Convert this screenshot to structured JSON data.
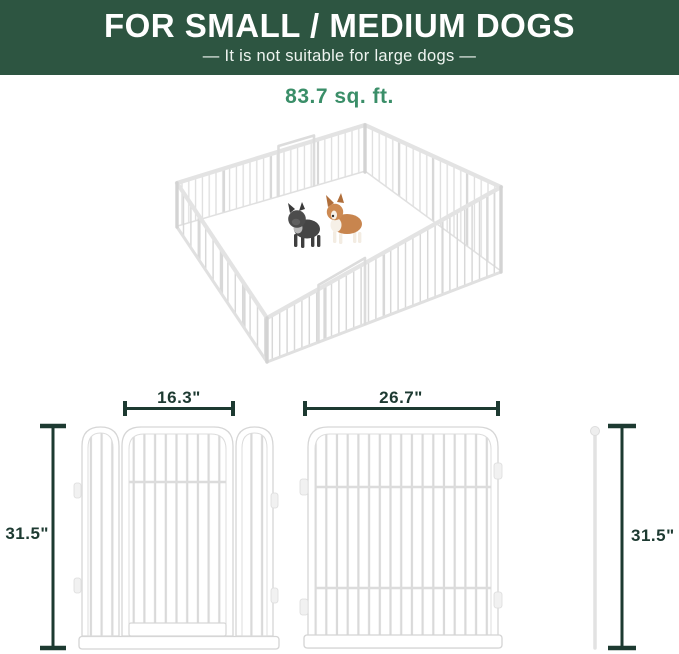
{
  "banner": {
    "title": "FOR SMALL / MEDIUM DOGS",
    "subtitle": "— It is not suitable for large dogs —",
    "bg_color": "#2d5541",
    "text_color": "#ffffff"
  },
  "area_label": "83.7 sq. ft.",
  "illustration": {
    "pen_style": "white wire playpen, 16 panels, square layout",
    "dog_left": "french-bulldog",
    "dog_right": "corgi"
  },
  "dimensions": {
    "door_section_width": "16.3\"",
    "panel_width": "26.7\"",
    "height_left": "31.5\"",
    "height_right": "31.5\""
  },
  "colors": {
    "banner_green": "#2d5541",
    "area_text_green": "#3a8e68",
    "dimension_dark_green": "#1d3a31",
    "panel_outline_gray": "#d6d6d6"
  }
}
